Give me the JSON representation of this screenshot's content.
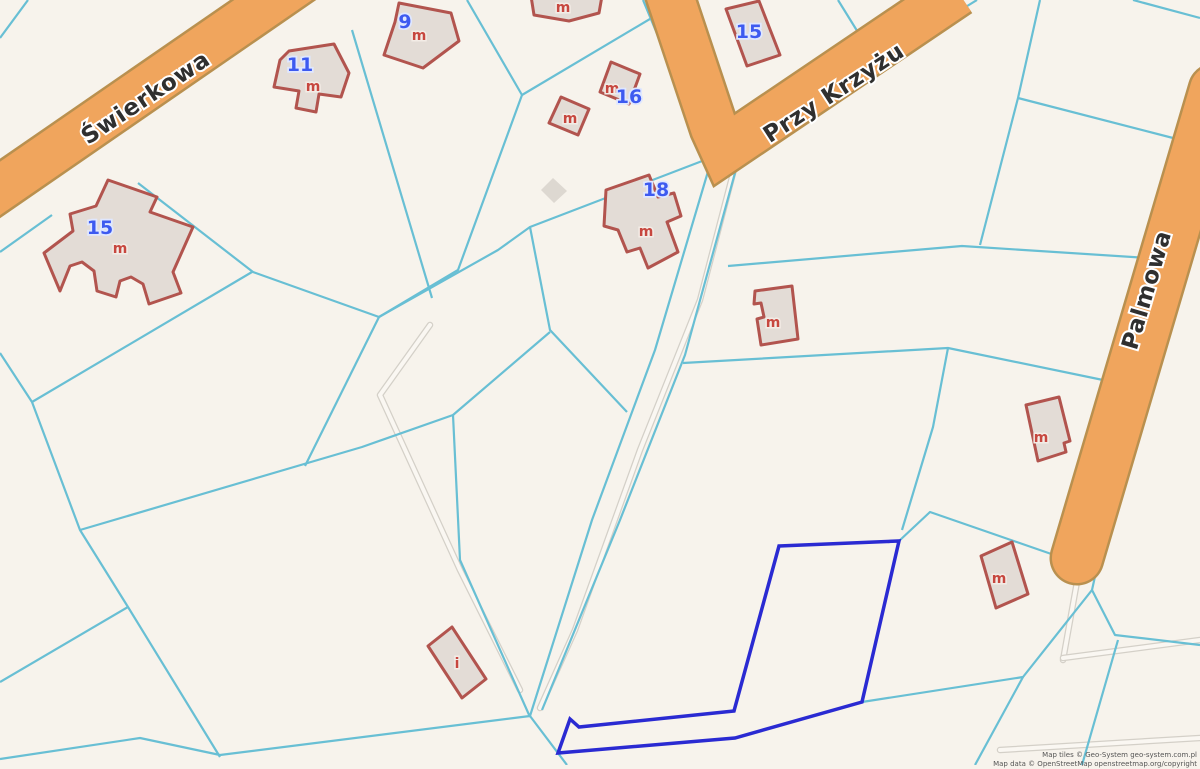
{
  "attribution": {
    "line1": "Map tiles © Geo-System geo-system.com.pl",
    "line2": "Map data © OpenStreetMap openstreetmap.org/copyright"
  },
  "colors": {
    "background": "#f7f3ec",
    "parcel_line": "#68bfd4",
    "road_fill": "#f0a55d",
    "road_casing": "#b9904f",
    "path_casing": "#d4d0c8",
    "path_core": "#faf7f2",
    "building_fill": "#e3dcd6",
    "building_stroke": "#b2544e",
    "shed_fill": "#ddd8d1",
    "selected_parcel": "#2a2ad2",
    "street_label": "#2f2f2f",
    "street_halo": "#ffffff",
    "number_label": "#3d5af0",
    "number_halo": "#dfe7ff",
    "letter_label": "#c7473f",
    "letter_halo": "#f3ece6",
    "attribution_text": "#555555"
  },
  "streets": [
    {
      "name": "Świerkowa",
      "x": 150,
      "y": 104,
      "angle": -33.5,
      "size": 23
    },
    {
      "name": "Przy Krzyżu",
      "x": 838,
      "y": 99,
      "angle": -33,
      "size": 23
    },
    {
      "name": "Palmowa",
      "x": 1154,
      "y": 292,
      "angle": -73.5,
      "size": 23
    }
  ],
  "roads": [
    {
      "id": "swierkowa",
      "points": [
        [
          -24,
          205
        ],
        [
          305,
          -22
        ]
      ],
      "width": 44,
      "round_end": false
    },
    {
      "id": "przy-krzyzu",
      "points": [
        [
          662,
          -28
        ],
        [
          714,
          128
        ],
        [
          724,
          150
        ],
        [
          958,
          -8
        ]
      ],
      "width": 46,
      "round_end": false
    },
    {
      "id": "palmowa",
      "points": [
        [
          1215,
          90
        ],
        [
          1077,
          558
        ]
      ],
      "width": 50,
      "round_end": true
    }
  ],
  "paths": [
    {
      "points": [
        [
          737,
          158
        ],
        [
          700,
          300
        ],
        [
          640,
          450
        ],
        [
          575,
          630
        ],
        [
          540,
          708
        ]
      ]
    },
    {
      "points": [
        [
          430,
          325
        ],
        [
          380,
          395
        ],
        [
          460,
          570
        ],
        [
          520,
          690
        ]
      ]
    },
    {
      "points": [
        [
          1080,
          565
        ],
        [
          1063,
          660
        ]
      ]
    },
    {
      "points": [
        [
          1063,
          658
        ],
        [
          1200,
          640
        ]
      ]
    },
    {
      "points": [
        [
          1000,
          750
        ],
        [
          1200,
          738
        ]
      ]
    }
  ],
  "parcel_lines": [
    [
      [
        0,
        214
      ],
      [
        332,
        -14
      ]
    ],
    [
      [
        28,
        0
      ],
      [
        0,
        38
      ]
    ],
    [
      [
        0,
        252
      ],
      [
        52,
        215
      ]
    ],
    [
      [
        138,
        183
      ],
      [
        253,
        272
      ],
      [
        379,
        317
      ]
    ],
    [
      [
        379,
        317
      ],
      [
        458,
        270
      ],
      [
        522,
        95
      ],
      [
        467,
        0
      ]
    ],
    [
      [
        522,
        95
      ],
      [
        660,
        13
      ]
    ],
    [
      [
        710,
        158
      ],
      [
        530,
        227
      ],
      [
        498,
        250
      ],
      [
        379,
        317
      ]
    ],
    [
      [
        32,
        402
      ],
      [
        252,
        272
      ]
    ],
    [
      [
        0,
        353
      ],
      [
        32,
        402
      ],
      [
        80,
        530
      ],
      [
        128,
        607
      ],
      [
        220,
        757
      ]
    ],
    [
      [
        128,
        607
      ],
      [
        0,
        682
      ]
    ],
    [
      [
        0,
        759
      ],
      [
        140,
        738
      ],
      [
        220,
        755
      ],
      [
        530,
        716
      ],
      [
        567,
        765
      ]
    ],
    [
      [
        712,
        158
      ],
      [
        655,
        350
      ],
      [
        592,
        520
      ],
      [
        530,
        716
      ]
    ],
    [
      [
        738,
        162
      ],
      [
        685,
        355
      ],
      [
        620,
        520
      ],
      [
        542,
        710
      ]
    ],
    [
      [
        643,
        0
      ],
      [
        697,
        130
      ],
      [
        724,
        156
      ],
      [
        977,
        0
      ]
    ],
    [
      [
        728,
        266
      ],
      [
        962,
        246
      ],
      [
        1148,
        258
      ]
    ],
    [
      [
        1040,
        0
      ],
      [
        1018,
        98
      ],
      [
        980,
        245
      ]
    ],
    [
      [
        1018,
        98
      ],
      [
        1173,
        138
      ]
    ],
    [
      [
        1133,
        0
      ],
      [
        1200,
        18
      ]
    ],
    [
      [
        838,
        0
      ],
      [
        864,
        42
      ]
    ],
    [
      [
        352,
        30
      ],
      [
        432,
        298
      ]
    ],
    [
      [
        530,
        227
      ],
      [
        550,
        330
      ],
      [
        627,
        412
      ]
    ],
    [
      [
        550,
        332
      ],
      [
        453,
        415
      ],
      [
        362,
        447
      ],
      [
        80,
        530
      ]
    ],
    [
      [
        453,
        415
      ],
      [
        460,
        560
      ],
      [
        530,
        717
      ]
    ],
    [
      [
        379,
        317
      ],
      [
        305,
        466
      ]
    ],
    [
      [
        683,
        363
      ],
      [
        948,
        348
      ],
      [
        1103,
        380
      ]
    ],
    [
      [
        948,
        348
      ],
      [
        933,
        427
      ],
      [
        902,
        530
      ]
    ],
    [
      [
        899,
        541
      ],
      [
        930,
        512
      ],
      [
        1060,
        557
      ]
    ],
    [
      [
        862,
        702
      ],
      [
        1023,
        677
      ],
      [
        1092,
        590
      ]
    ],
    [
      [
        1023,
        677
      ],
      [
        975,
        765
      ]
    ],
    [
      [
        1215,
        130
      ],
      [
        1188,
        243
      ],
      [
        1112,
        500
      ],
      [
        1092,
        590
      ],
      [
        1115,
        635
      ],
      [
        1200,
        645
      ]
    ],
    [
      [
        1118,
        640
      ],
      [
        1082,
        765
      ]
    ]
  ],
  "selected_parcel": {
    "points": [
      [
        779,
        546
      ],
      [
        899,
        541
      ],
      [
        862,
        702
      ],
      [
        735,
        738
      ],
      [
        558,
        753
      ],
      [
        570,
        719
      ],
      [
        579,
        727
      ],
      [
        734,
        711
      ]
    ]
  },
  "buildings": [
    {
      "id": "bldg-swierkowa-15",
      "points": [
        [
          108,
          180
        ],
        [
          157,
          197
        ],
        [
          150,
          212
        ],
        [
          193,
          227
        ],
        [
          173,
          272
        ],
        [
          181,
          293
        ],
        [
          149,
          304
        ],
        [
          143,
          284
        ],
        [
          131,
          277
        ],
        [
          120,
          281
        ],
        [
          116,
          297
        ],
        [
          97,
          291
        ],
        [
          94,
          271
        ],
        [
          82,
          262
        ],
        [
          70,
          266
        ],
        [
          60,
          291
        ],
        [
          44,
          253
        ],
        [
          73,
          231
        ],
        [
          70,
          214
        ],
        [
          96,
          206
        ]
      ]
    },
    {
      "id": "bldg-11",
      "points": [
        [
          289,
          51
        ],
        [
          334,
          44
        ],
        [
          349,
          73
        ],
        [
          341,
          97
        ],
        [
          319,
          94
        ],
        [
          316,
          112
        ],
        [
          296,
          108
        ],
        [
          299,
          91
        ],
        [
          274,
          87
        ],
        [
          280,
          60
        ]
      ]
    },
    {
      "id": "bldg-9",
      "points": [
        [
          399,
          3
        ],
        [
          451,
          13
        ],
        [
          459,
          41
        ],
        [
          423,
          68
        ],
        [
          384,
          55
        ],
        [
          395,
          22
        ]
      ]
    },
    {
      "id": "bldg-top-m",
      "points": [
        [
          531,
          -4
        ],
        [
          602,
          -4
        ],
        [
          599,
          13
        ],
        [
          569,
          21
        ],
        [
          534,
          15
        ]
      ]
    },
    {
      "id": "bldg-small-m",
      "points": [
        [
          561,
          97
        ],
        [
          589,
          109
        ],
        [
          578,
          135
        ],
        [
          549,
          123
        ]
      ]
    },
    {
      "id": "bldg-16",
      "points": [
        [
          611,
          62
        ],
        [
          640,
          74
        ],
        [
          629,
          104
        ],
        [
          600,
          92
        ]
      ]
    },
    {
      "id": "bldg-przykrzyzu-15",
      "points": [
        [
          726,
          9
        ],
        [
          759,
          1
        ],
        [
          780,
          55
        ],
        [
          747,
          66
        ]
      ]
    },
    {
      "id": "bldg-18",
      "points": [
        [
          606,
          190
        ],
        [
          649,
          175
        ],
        [
          658,
          197
        ],
        [
          674,
          193
        ],
        [
          681,
          216
        ],
        [
          667,
          222
        ],
        [
          678,
          252
        ],
        [
          648,
          268
        ],
        [
          640,
          248
        ],
        [
          627,
          252
        ],
        [
          618,
          230
        ],
        [
          604,
          226
        ]
      ]
    },
    {
      "id": "bldg-mid-m",
      "points": [
        [
          755,
          291
        ],
        [
          792,
          286
        ],
        [
          798,
          339
        ],
        [
          761,
          345
        ],
        [
          757,
          319
        ],
        [
          764,
          317
        ],
        [
          761,
          303
        ],
        [
          754,
          304
        ]
      ]
    },
    {
      "id": "bldg-palmowa-m1",
      "points": [
        [
          1026,
          405
        ],
        [
          1059,
          397
        ],
        [
          1070,
          441
        ],
        [
          1064,
          443
        ],
        [
          1066,
          452
        ],
        [
          1038,
          461
        ]
      ]
    },
    {
      "id": "bldg-palmowa-m2",
      "points": [
        [
          981,
          556
        ],
        [
          1012,
          542
        ],
        [
          1028,
          594
        ],
        [
          996,
          608
        ]
      ]
    },
    {
      "id": "bldg-i",
      "points": [
        [
          452,
          627
        ],
        [
          486,
          679
        ],
        [
          462,
          698
        ],
        [
          428,
          646
        ]
      ]
    }
  ],
  "sheds": [
    {
      "id": "shed-gray",
      "points": [
        [
          553,
          178
        ],
        [
          567,
          191
        ],
        [
          554,
          203
        ],
        [
          541,
          190
        ]
      ]
    }
  ],
  "house_numbers": [
    {
      "text": "15",
      "x": 100,
      "y": 234
    },
    {
      "text": "11",
      "x": 300,
      "y": 71
    },
    {
      "text": "9",
      "x": 405,
      "y": 28
    },
    {
      "text": "16",
      "x": 629,
      "y": 103
    },
    {
      "text": "15",
      "x": 749,
      "y": 38
    },
    {
      "text": "18",
      "x": 656,
      "y": 196
    }
  ],
  "building_letters": [
    {
      "text": "m",
      "x": 120,
      "y": 253
    },
    {
      "text": "m",
      "x": 313,
      "y": 91
    },
    {
      "text": "m",
      "x": 419,
      "y": 40
    },
    {
      "text": "m",
      "x": 563,
      "y": 12
    },
    {
      "text": "m",
      "x": 570,
      "y": 123
    },
    {
      "text": "m",
      "x": 612,
      "y": 93
    },
    {
      "text": "m",
      "x": 646,
      "y": 236
    },
    {
      "text": "m",
      "x": 773,
      "y": 327
    },
    {
      "text": "m",
      "x": 1041,
      "y": 442
    },
    {
      "text": "m",
      "x": 999,
      "y": 583
    },
    {
      "text": "i",
      "x": 457,
      "y": 668
    }
  ]
}
